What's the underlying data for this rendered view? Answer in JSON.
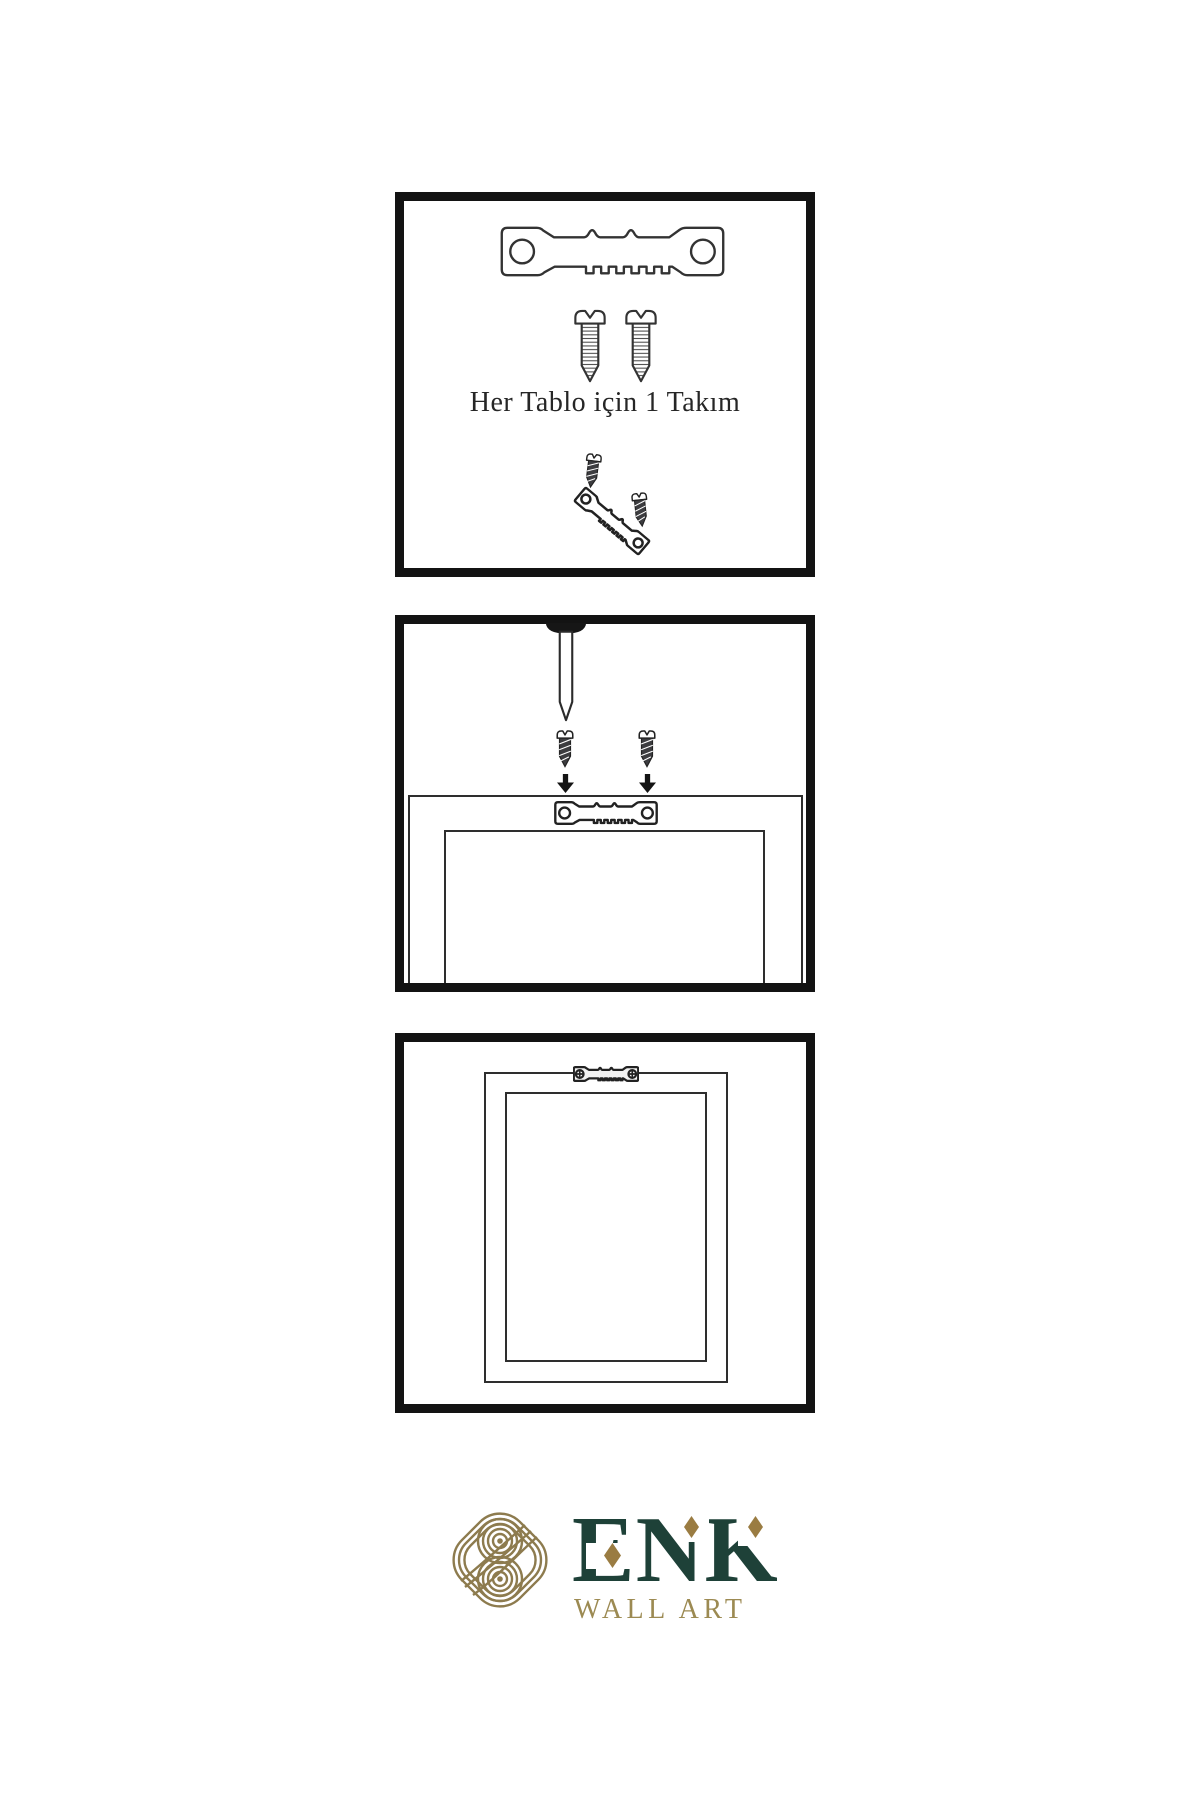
{
  "page": {
    "background_color": "#ffffff",
    "style": "wall-art hanging instruction sheet"
  },
  "instruction_panels": [
    {
      "name": "hardware-kit",
      "caption": "Her Tablo için 1 Takım",
      "illustrations": [
        "sawtooth-hanger",
        "mounting-screw",
        "mounting-screw",
        "screw-driven-into-angled-hanger"
      ]
    },
    {
      "name": "attach-hanger-to-frame-back",
      "illustrations": [
        "wall-nail",
        "screw-with-down-arrow",
        "screw-with-down-arrow",
        "frame-back-with-sawtooth-hanger"
      ]
    },
    {
      "name": "frame-mounted",
      "illustrations": [
        "frame-back-with-screwed-sawtooth-hanger"
      ]
    }
  ],
  "logo": {
    "brand": "ENK",
    "tagline": "WALL ART",
    "mark": "interlocking-knot",
    "brand_color": "#1e4138",
    "gold_color": "#8d7b4e",
    "diamond_color": "#9a7c42"
  }
}
